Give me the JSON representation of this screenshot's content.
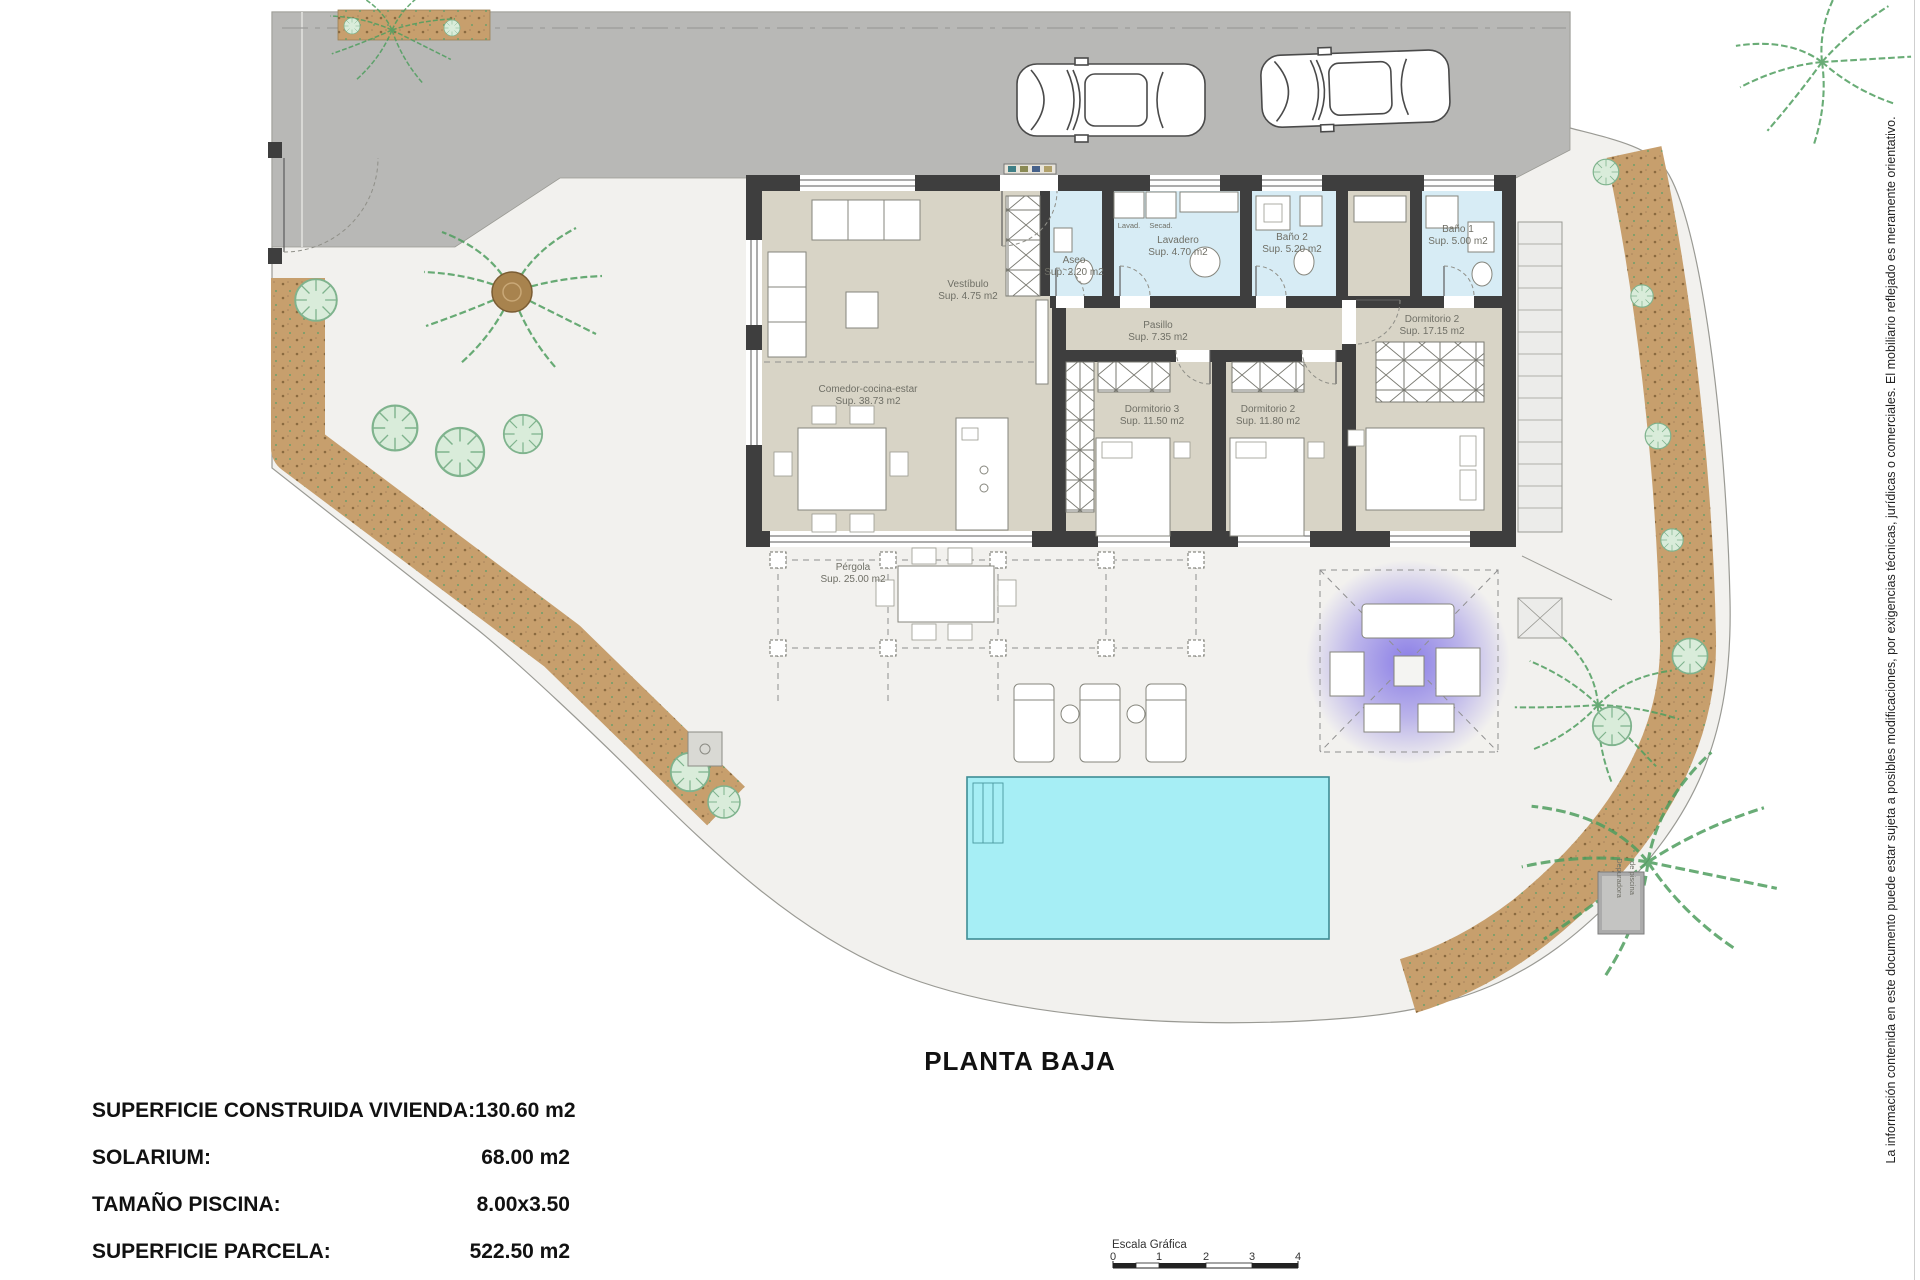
{
  "title": "PLANTA BAJA",
  "disclaimer": "La información contenida en este documento puede estar sujeta a posibles modificaciones, por exigencias técnicas, jurídicas o comerciales. El mobiliario reflejado es meramente orientativo.",
  "rooms": {
    "living": {
      "name": "Comedor-cocina-estar",
      "area": "Sup. 38.73 m2"
    },
    "vestibulo": {
      "name": "Vestíbulo",
      "area": "Sup. 4.75 m2"
    },
    "aseo": {
      "name": "Aseo",
      "area": "Sup. 2.20 m2"
    },
    "lavadero": {
      "name": "Lavadero",
      "area": "Sup. 4.70 m2"
    },
    "bano2": {
      "name": "Baño 2",
      "area": "Sup. 5.20 m2"
    },
    "bano1": {
      "name": "Baño 1",
      "area": "Sup. 5.00 m2"
    },
    "pasillo": {
      "name": "Pasillo",
      "area": "Sup. 7.35 m2"
    },
    "dorm3": {
      "name": "Dormitorio 3",
      "area": "Sup. 11.50 m2"
    },
    "dorm2": {
      "name": "Dormitorio 2",
      "area": "Sup. 11.80 m2"
    },
    "dorm1": {
      "name": "Dormitorio 2",
      "area": "Sup. 17.15 m2"
    },
    "pergola": {
      "name": "Pérgola",
      "area": "Sup. 25.00 m2"
    }
  },
  "appliances": {
    "washer": "Lavad.",
    "dryer": "Secad."
  },
  "pool_equipment": {
    "line1": "Depuradora",
    "line2": "de piscina"
  },
  "summary": {
    "rows": [
      {
        "label": "SUPERFICIE CONSTRUIDA VIVIENDA:",
        "value": "130.60 m2"
      },
      {
        "label": "SOLARIUM:",
        "value": "68.00 m2"
      },
      {
        "label": "TAMAÑO PISCINA:",
        "value": "8.00x3.50"
      },
      {
        "label": "SUPERFICIE PARCELA:",
        "value": "522.50 m2"
      }
    ]
  },
  "scale_bar": {
    "title": "Escala Gráfica",
    "ticks": [
      "0",
      "1",
      "2",
      "3",
      "4"
    ]
  },
  "colors": {
    "driveway": "#b8b8b6",
    "plot": "#f2f1ee",
    "walls": "#3e3e3e",
    "floor_beige": "#d8d4c6",
    "floor_wet_blue": "#d7ecf5",
    "pool": "#a6eef5",
    "garden_tan": "#c79f6d",
    "plants_green": "#4f9e5f",
    "pergola_purple": "#8578e6"
  }
}
